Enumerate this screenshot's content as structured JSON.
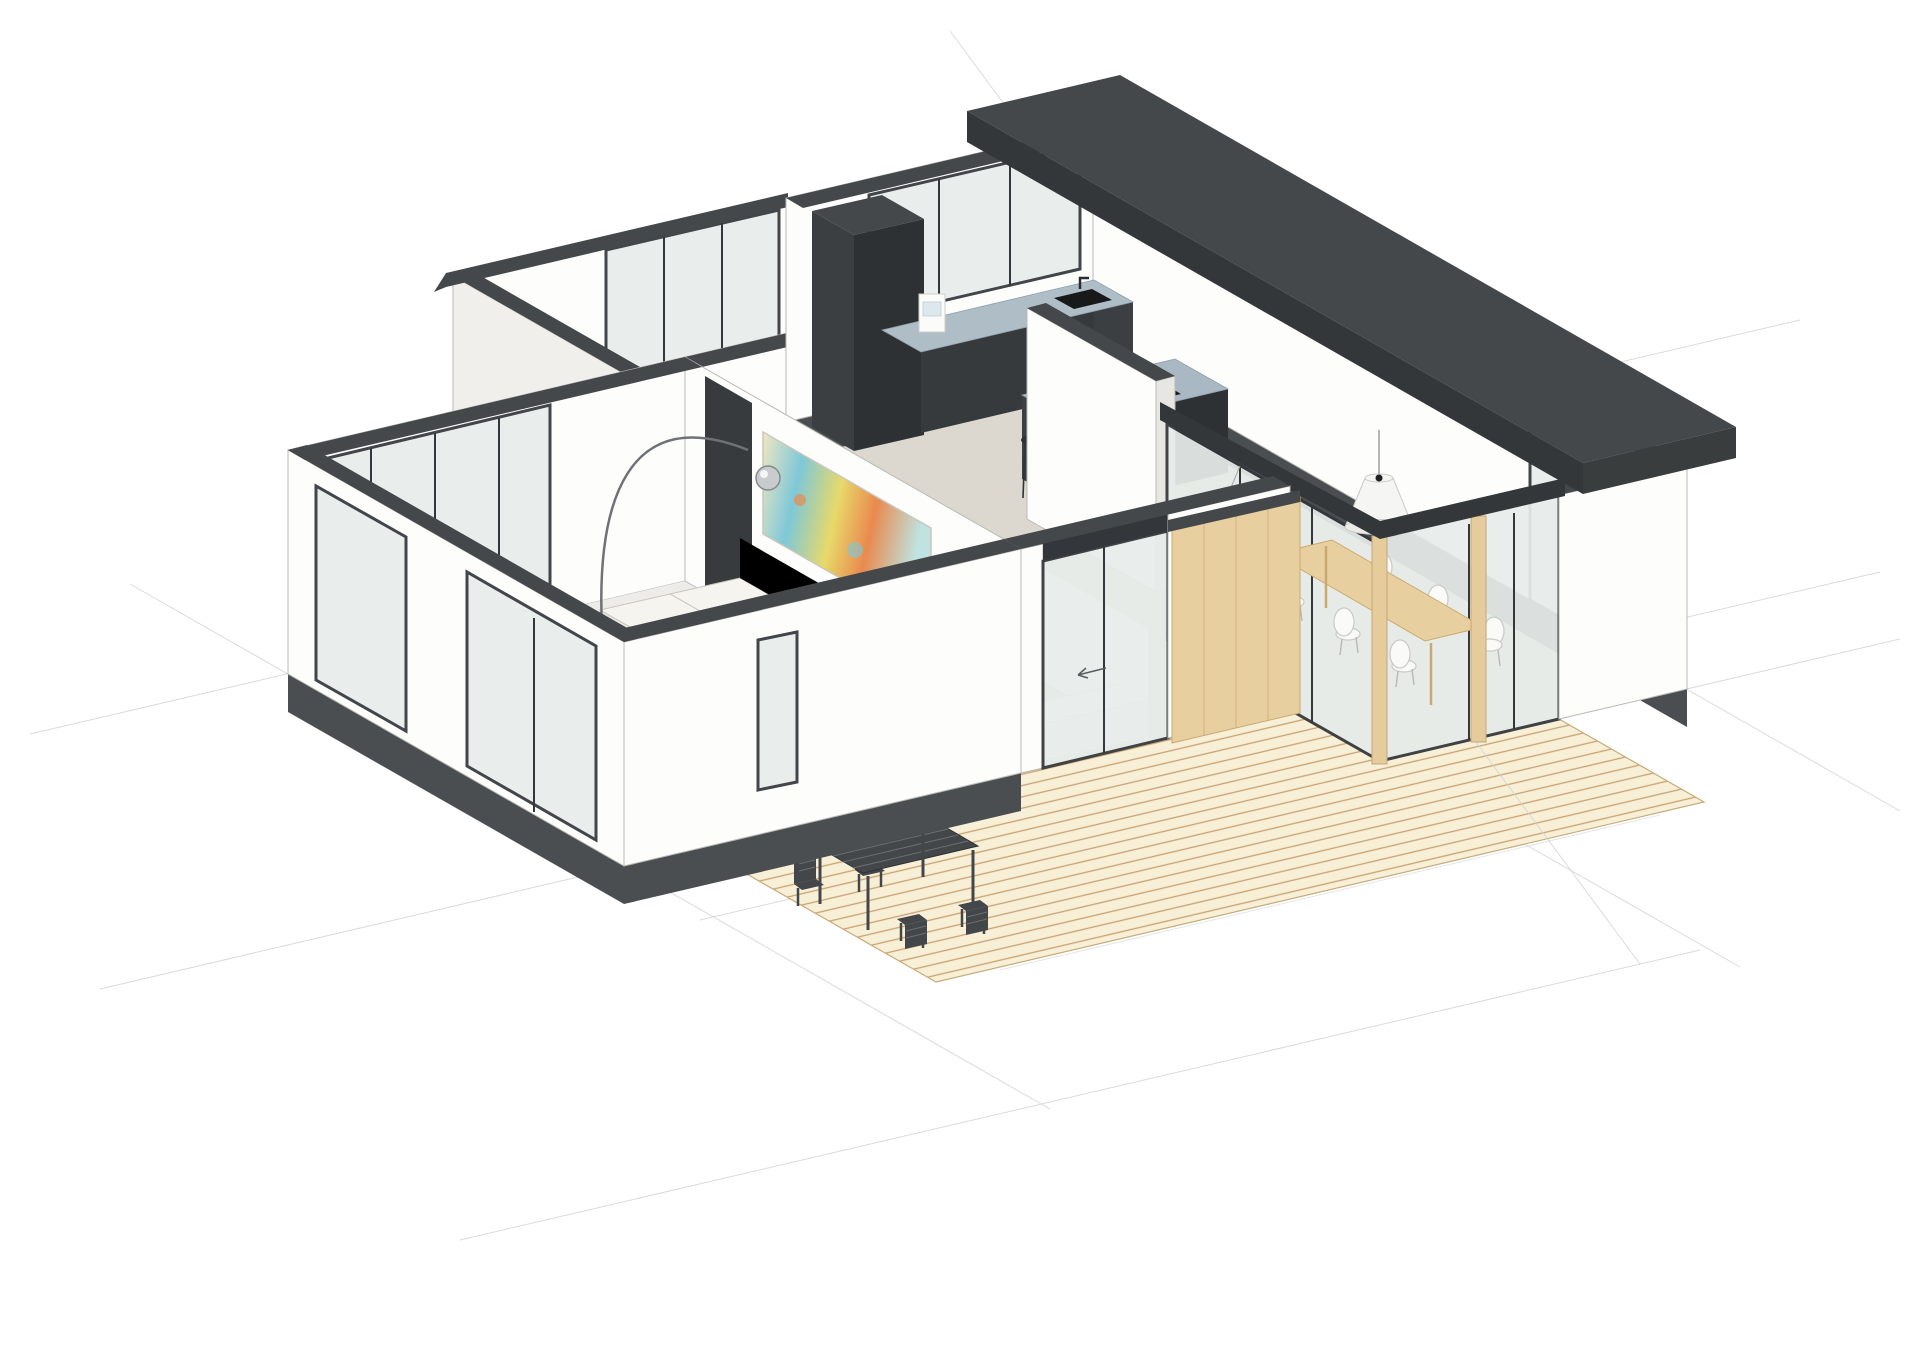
{
  "meta": {
    "view_type": "axonometric-3d-cutaway-floor-plan-render",
    "style": "architectural BIM render, white background, dark wall caps"
  },
  "palette": {
    "bg": "#ffffff",
    "gridline": "#d3d5d3",
    "edge": "#b9b9b5",
    "wall_white": "#fdfdfc",
    "wall_shade_1": "#f0efec",
    "wall_shade_2": "#e7e6e2",
    "cap_dark": "#45484b",
    "plinth": "#4b4e51",
    "frame_dark": "#33363a",
    "glass": "#e8edeb",
    "glass_light": "#eef2f0",
    "diag_line": "#a6aaa8",
    "floor_beige": "#dcd8cf",
    "floor_light": "#edece8",
    "rug": "#c6c4c0",
    "rug_dot": "#a9a7a3",
    "deck_base": "#f8efd7",
    "deck_line": "#c9a271",
    "timber": "#e8cfa0",
    "timber_grain": "#d4b27c",
    "post": "#e6cb9b",
    "counter_top": "#aebdc6",
    "island_top": "#a9b8c2",
    "cabinet_dark": "#373a3d",
    "cabinet_darker": "#2e3134",
    "cabinet_side": "#3c3f42",
    "cooktop": "#17191b",
    "sofa_top": "#f6f4ef",
    "sofa_front": "#eae7e0",
    "sofa_side": "#e5e2db",
    "sofa_back": "#f1efe8",
    "sofa_line": "#c9c6bd",
    "pouf": "#f3dfa0",
    "pouf_stroke": "#dec07f",
    "painting_1": "#f2e7c0",
    "painting_2": "#e8d96a",
    "painting_3": "#7ec8d8",
    "painting_4": "#e98a4e",
    "painting_5": "#bfe3e0",
    "chrome": "#c9ccce",
    "chrome_dark": "#86898c",
    "pendant": "#f5f5f3",
    "chair_white": "#fafaf8",
    "chair_stroke": "#c9c9c6",
    "outdoor_dark": "#43474a",
    "outdoor_slat": "#6a6e72",
    "roof_top": "#45484b",
    "roof_fascia": "#34373a",
    "door_dark": "#383b3e",
    "vanity": "#f4f3f0"
  },
  "scene": {
    "rooms": [
      {
        "name": "living-room"
      },
      {
        "name": "bedroom"
      },
      {
        "name": "hallway"
      },
      {
        "name": "bathroom"
      },
      {
        "name": "kitchen"
      },
      {
        "name": "dining-area"
      },
      {
        "name": "terrace-deck"
      }
    ],
    "objects": [
      {
        "name": "l-shaped-sofa"
      },
      {
        "name": "arc-floor-lamp"
      },
      {
        "name": "abstract-painting"
      },
      {
        "name": "area-rug"
      },
      {
        "name": "round-pouf",
        "count": 2
      },
      {
        "name": "kitchen-counter-with-sink"
      },
      {
        "name": "kitchen-island-with-cooktop"
      },
      {
        "name": "coffee-machine"
      },
      {
        "name": "bar-stool"
      },
      {
        "name": "dining-table"
      },
      {
        "name": "dining-chair",
        "count": 6
      },
      {
        "name": "cone-pendant-lamp"
      },
      {
        "name": "outdoor-table"
      },
      {
        "name": "outdoor-chair",
        "count": 4
      },
      {
        "name": "timber-sliding-door"
      },
      {
        "name": "glass-sliding-door"
      },
      {
        "name": "wood-deck"
      },
      {
        "name": "timber-post",
        "count": 2
      },
      {
        "name": "flat-roof-slab"
      },
      {
        "name": "bathroom-vanity"
      }
    ]
  }
}
